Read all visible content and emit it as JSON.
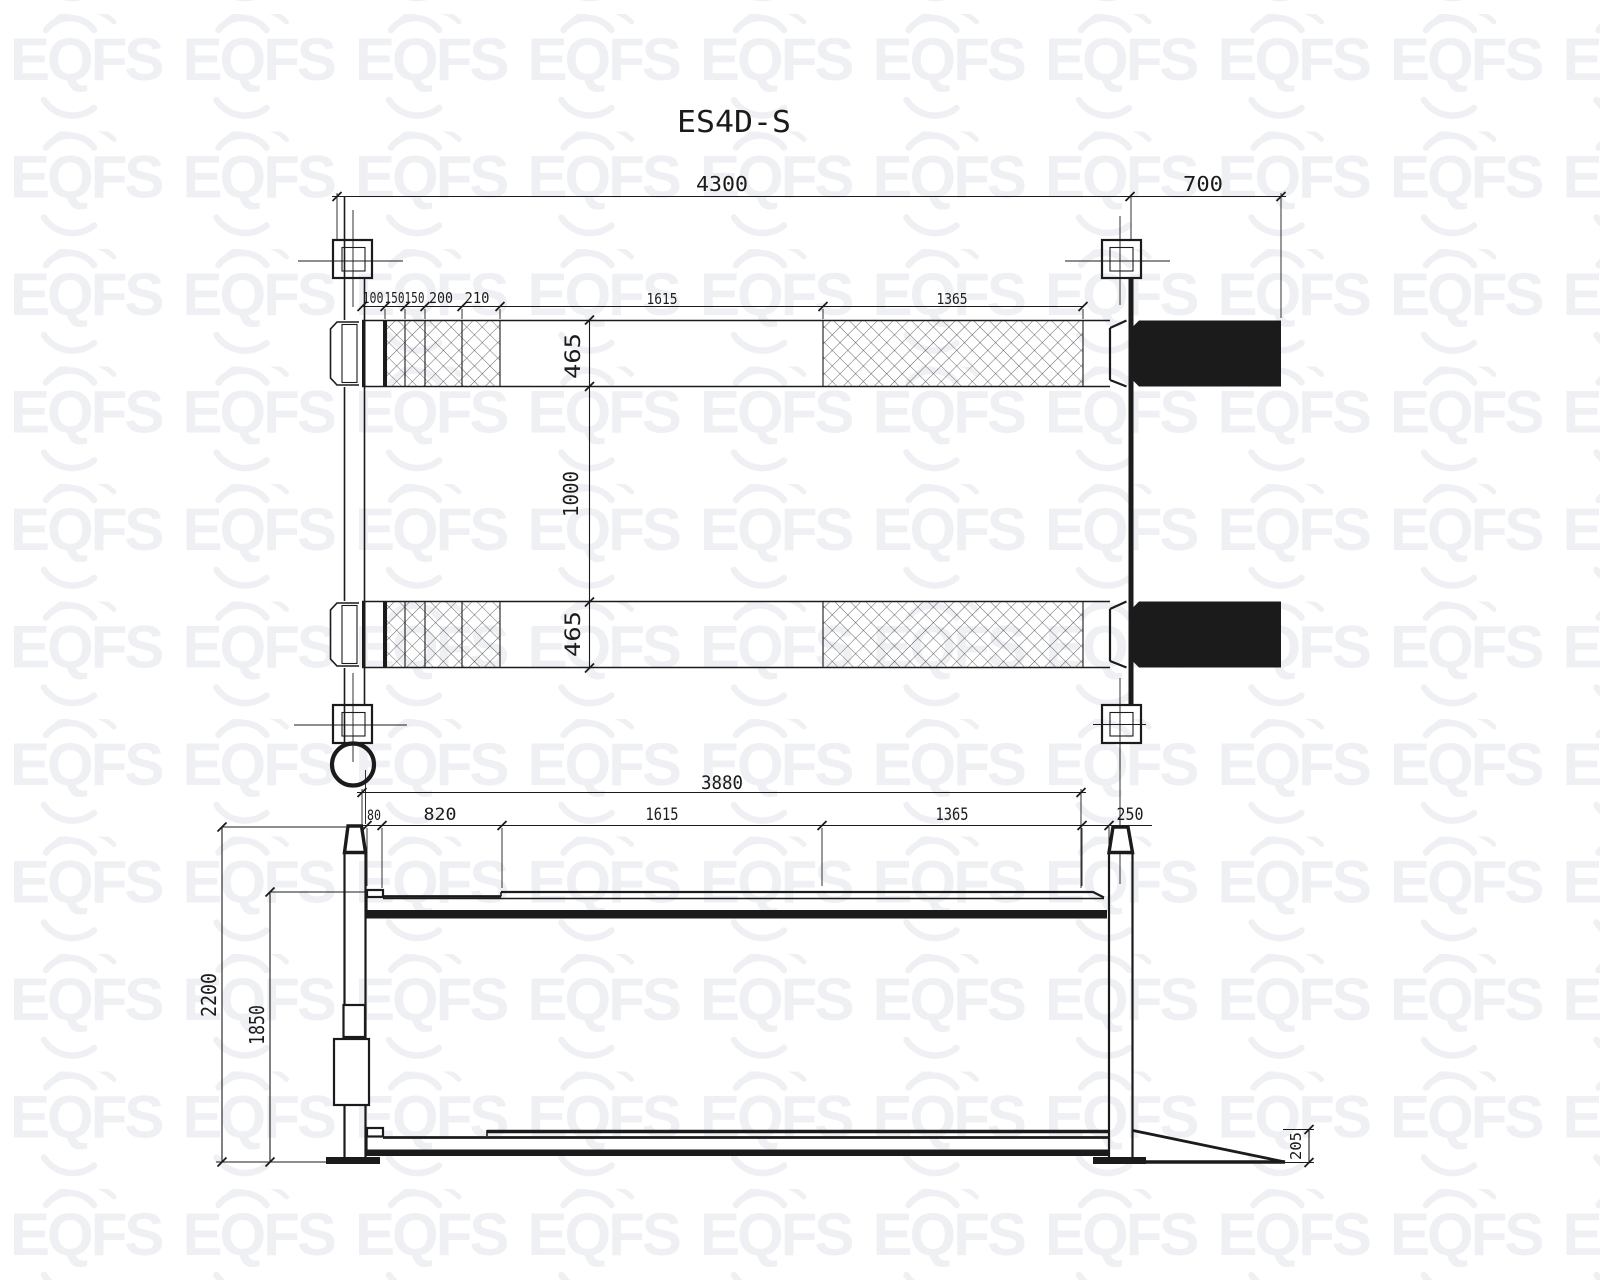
{
  "title": "ES4D-S",
  "watermark": {
    "text": "EQFS"
  },
  "colors": {
    "line": "#1b1b1b",
    "watermark": "#eef0f3",
    "background": "#ffffff"
  },
  "plan_view": {
    "overall_length": "4300",
    "ramp_length": "700",
    "segments": [
      "100",
      "150",
      "150",
      "200",
      "210",
      "1615",
      "1365"
    ],
    "runway_width_front": "465",
    "track_gap": "1000",
    "runway_width_rear": "465"
  },
  "side_view": {
    "platform_length": "3880",
    "segments": [
      "80",
      "820",
      "1615",
      "1365",
      "250"
    ],
    "overall_height": "2200",
    "raised_height": "1850",
    "lowered_height": "205"
  }
}
